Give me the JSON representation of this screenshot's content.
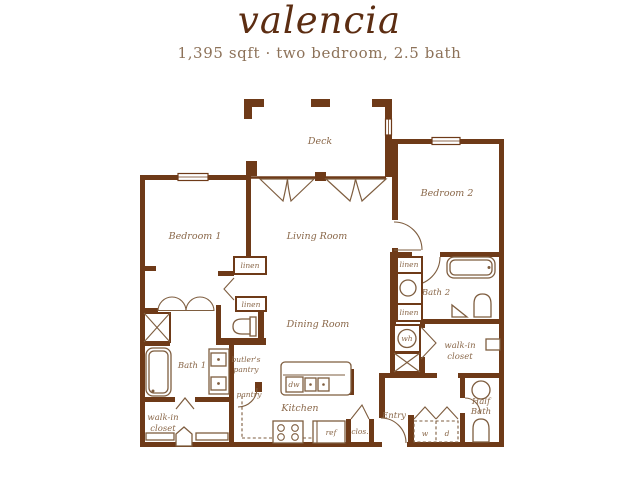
{
  "header": {
    "title": "valencia",
    "subtitle": "1,395 sqft · two bedroom, 2.5 bath"
  },
  "colors": {
    "wall": "#6e3a18",
    "fixture": "#7e5d3f",
    "label": "#8a684a",
    "title": "#5c2d12",
    "subtitle": "#8d7259",
    "background": "#ffffff"
  },
  "rooms": {
    "deck": "Deck",
    "bedroom1": "Bedroom 1",
    "bedroom2": "Bedroom 2",
    "living_room": "Living Room",
    "dining_room": "Dining Room",
    "kitchen": "Kitchen",
    "bath1": "Bath 1",
    "bath2": "Bath 2",
    "half_bath_line1": "Half",
    "half_bath_line2": "Bath",
    "entry": "Entry",
    "walk_in_line1": "walk-in",
    "walk_in_line2": "closet",
    "butlers_line1": "butler's",
    "butlers_line2": "pantry",
    "pantry": "pantry"
  },
  "labels": {
    "linen": "linen",
    "water_heater": "wh",
    "dishwasher": "dw",
    "refrigerator": "ref",
    "closet_abbr": "clos.",
    "washer": "w",
    "dryer": "d"
  }
}
